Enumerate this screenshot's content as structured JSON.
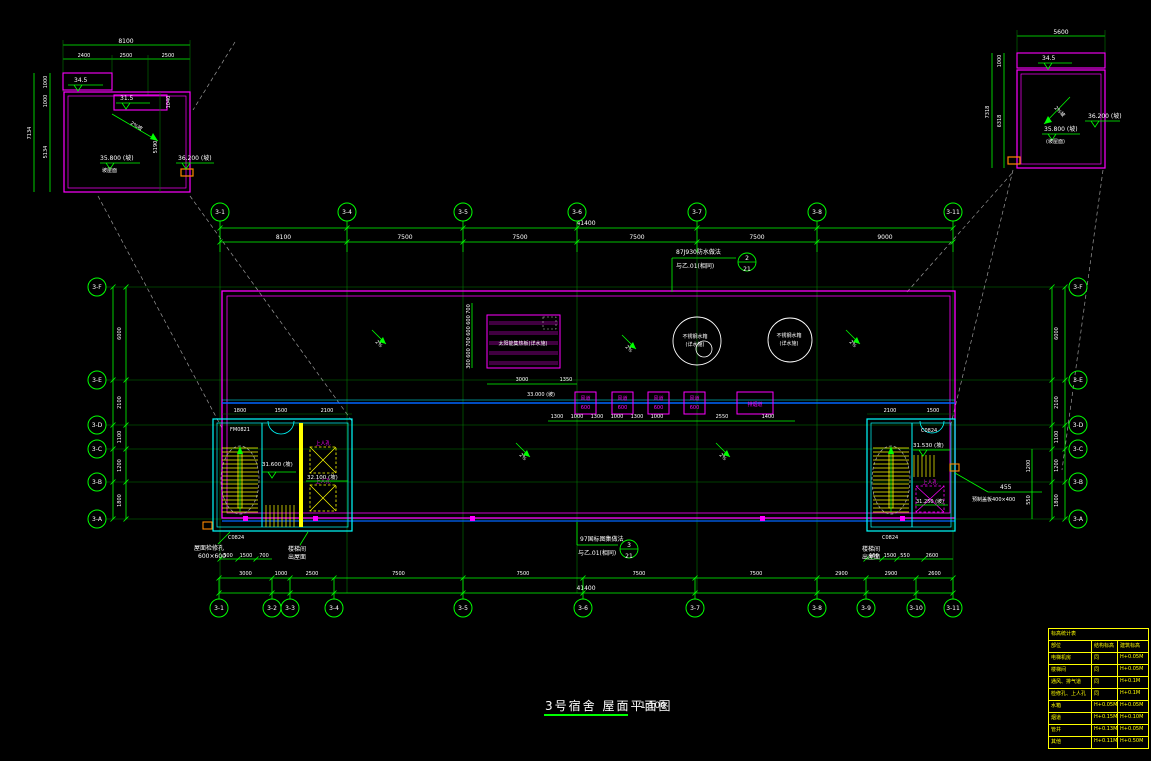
{
  "title": {
    "text": "3号宿舍 屋面平面图",
    "scale": "1:100"
  },
  "colors": {
    "line": "#00ff00",
    "outline": "#ff00ff",
    "wall": "#00ffff",
    "stair": "#ffff00",
    "pipe": "#0066ff",
    "scupper": "#ff8800",
    "text": "#ffffff"
  },
  "grid": {
    "top": {
      "labels": [
        "3-1",
        "3-4",
        "3-5",
        "3-6",
        "3-7",
        "3-8",
        "3-11"
      ],
      "dims": [
        "8100",
        "7500",
        "7500",
        "7500",
        "7500",
        "9000"
      ],
      "total": "41400"
    },
    "bottom": {
      "labels": [
        "3-1",
        "3-2",
        "3-3",
        "3-4",
        "3-5",
        "3-6",
        "3-7",
        "3-8",
        "3-9",
        "3-10",
        "3-11"
      ],
      "dims": [
        "3000",
        "1000",
        "2500",
        "7500",
        "7500",
        "7500",
        "7500",
        "2900",
        "2900",
        "2600"
      ],
      "small_left": [
        "300",
        "1500",
        "700"
      ],
      "small_right": [
        "150",
        "1500",
        "550",
        "2600"
      ],
      "total": "41400"
    },
    "left": {
      "labels": [
        "3-F",
        "3-E",
        "3-D",
        "3-C",
        "3-B",
        "3-A"
      ],
      "dims": [
        "6000",
        "2100",
        "1100",
        "1200",
        "1800"
      ]
    },
    "right": {
      "labels": [
        "3-F",
        "3-E",
        "3-D",
        "3-C",
        "3-B",
        "3-A"
      ],
      "dims": [
        "6000",
        "2100",
        "1100",
        "1200",
        "1800"
      ]
    }
  },
  "detail_left": {
    "width_total": "8100",
    "widths": [
      "2400",
      "2500",
      "2500"
    ],
    "height_total": "7134",
    "heights": [
      "1000",
      "1000",
      "5134"
    ],
    "inner_v1": "1040",
    "inner_v2": "5190",
    "elev_upper": "34.5",
    "elev_lower": "31.5",
    "elev_main": "35.800 (坡)",
    "elev_main_note": "坡屋面",
    "elev_edge": "36.200 (坡)",
    "slope": "2%坡"
  },
  "detail_right": {
    "width_total": "5600",
    "height_total": "7318",
    "heights": [
      "1000",
      "6318"
    ],
    "elev_upper": "34.5",
    "elev_main": "35.800 (坡)",
    "elev_main_note": "(坡屋面)",
    "elev_edge": "36.200 (坡)",
    "slope": "2%坡"
  },
  "plan": {
    "callout_top": {
      "line1": "87J930防水做法",
      "line2": "与乙.01(相同)",
      "num": "2",
      "sheet": "21"
    },
    "callout_bottom": {
      "line1": "97国标图集做法",
      "line2": "与乙.01(相同)",
      "num": "3",
      "sheet": "21"
    },
    "solar": {
      "label": "太阳能集热板(详水施)",
      "v_dims": [
        "700",
        "600",
        "600",
        "700",
        "600",
        "300"
      ],
      "h_dims": [
        "3000",
        "1350"
      ]
    },
    "tank1": {
      "line1": "不锈钢水箱",
      "line2": "(详水施)"
    },
    "tank2": {
      "line1": "不锈钢水箱",
      "line2": "(详水施)"
    },
    "vents": {
      "small_line1": "风道",
      "small_line2": "600",
      "wide_label": "排烟道",
      "dims": [
        "1300",
        "1000",
        "1300",
        "1000",
        "1300",
        "1000",
        "2550",
        "1400"
      ]
    },
    "line_elev": "33.000 (坡)",
    "slope_label": "2%",
    "left_core": {
      "door_tag": "FM0821",
      "window_tag": "C0824",
      "elev_room": "31.600 (坡)",
      "elev_right": "32.100 (坡)",
      "hatch_label": "上人孔",
      "note1_l1": "屋面检修孔",
      "note1_l2": "600×600",
      "note2_l1": "楼梯间",
      "note2_l2": "出屋面",
      "top_dims": [
        "1800",
        "1500",
        "2100"
      ]
    },
    "right_core": {
      "tag_top": "C0824",
      "window_tag": "C0824",
      "elev_room": "31.530 (坡)",
      "elev_hatch": "31.250 (坡)",
      "hatch_label": "上人孔",
      "note_l1": "楼梯间",
      "note_l2": "出屋面",
      "top_dims": [
        "2100",
        "1500"
      ],
      "side_dim1": "1200",
      "side_dim2": "550"
    },
    "parapet_note": {
      "dim": "455",
      "text": "预制盖板400×400"
    }
  },
  "table": {
    "title": "标高统计表",
    "header": [
      "部位",
      "结构标高",
      "建筑标高"
    ],
    "rows": [
      [
        "电梯机房",
        "同",
        "H+0.05M"
      ],
      [
        "楼梯间",
        "同",
        "H+0.05M"
      ],
      [
        "通风、排气道",
        "同",
        "H+0.1M"
      ],
      [
        "检修孔、上人孔",
        "同",
        "H+0.1M"
      ],
      [
        "水箱",
        "H+0.05M",
        "H+0.05M"
      ],
      [
        "烟道",
        "H+0.15M",
        "H+0.10M"
      ],
      [
        "管井",
        "H+0.13M",
        "H+0.05M"
      ],
      [
        "其他",
        "H+0.11M",
        "H+0.50M"
      ]
    ]
  }
}
